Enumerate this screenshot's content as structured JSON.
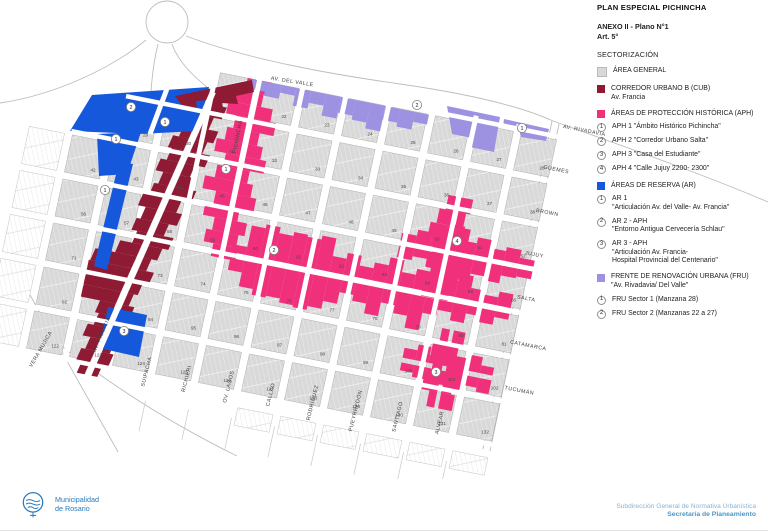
{
  "header": {
    "title": "PLAN ESPECIAL PICHINCHA",
    "anexo": "ANEXO II - Plano N°1",
    "art": "Art. 5°",
    "section": "SECTORIZACIÓN"
  },
  "colors": {
    "area_general": "#d9d9d9",
    "cub": "#8e1a33",
    "aph": "#f0307a",
    "ar": "#1558dc",
    "fru": "#9d92e2",
    "brand_blue": "#2779bd"
  },
  "legend": {
    "area_general": {
      "label": "ÁREA GENERAL"
    },
    "cub": {
      "label": "CORREDOR URBANO B (CUB)",
      "sub": "Av. Francia"
    },
    "aph": {
      "label": "ÁREAS DE PROTECCIÓN HISTÓRICA (APH)",
      "items": [
        {
          "n": "1",
          "text": "APH 1  \"Ámbito Histórico Pichincha\""
        },
        {
          "n": "2",
          "text": "APH 2  \"Corredor Urbano Salta\""
        },
        {
          "n": "3",
          "text": "APH 3  \"Casa del Estudiante\""
        },
        {
          "n": "4",
          "text": "APH 4  \"Calle Jujuy 2200- 2300\""
        }
      ]
    },
    "ar": {
      "label": "ÁREAS DE RESERVA (AR)",
      "items": [
        {
          "n": "1",
          "lines": [
            "AR 1",
            "\"Articulación Av. del Valle- Av. Francia\""
          ]
        },
        {
          "n": "2",
          "lines": [
            "AR 2 - APH",
            "\"Entorno Antigua Cervecería Schlau\""
          ]
        },
        {
          "n": "3",
          "lines": [
            "AR 3 - APH",
            "\"Articulación Av. Francia-",
            "Hospital Provincial del Centenario\""
          ]
        }
      ]
    },
    "fru": {
      "label": "FRENTE DE RENOVACIÓN URBANA (FRU)",
      "sub": "\"Av. Rivadavia/ Del Valle\"",
      "items": [
        {
          "n": "1",
          "text": "FRU Sector 1 (Manzana 28)"
        },
        {
          "n": "2",
          "text": "FRU Sector 2 (Manzanas 22 a 27)"
        }
      ]
    }
  },
  "footer": {
    "org_line1": "Municipalidad",
    "org_line2": "de Rosario",
    "right_line1": "Subdirección General de Normativa Urbanística",
    "right_line2": "Secretaría de Planeamiento"
  },
  "map": {
    "loop": {
      "cx": 167,
      "cy": 22,
      "r": 21
    },
    "decor": [
      "M 0 103 C 55 95 112 68 146 40",
      "M 172 44 C 178 62 194 77 213 92",
      "M 158 44 C 151 72 150 100 150 133",
      "M 186 36 C 250 60 330 74 400 84 C 470 94 522 107 553 121",
      "M 553 121 C 640 152 712 178 768 202",
      "M 552 121 L 483 449",
      "M 559 124 L 490 451",
      "M 30 295 L 118 452",
      "M 60 345 C 120 392 180 428 237 456"
    ],
    "block_rows": [
      {
        "row": 0,
        "start_col": 3,
        "numbers": [
          "",
          "22",
          "23",
          "24",
          "25",
          "26",
          "27",
          "28"
        ]
      },
      {
        "row": 1,
        "start_col": 1,
        "numbers": [
          "29",
          "30",
          "31",
          "32",
          "33",
          "34",
          "35",
          "36",
          "37",
          "38"
        ]
      },
      {
        "row": 2,
        "start_col": 0,
        "numbers": [
          "42",
          "43",
          "44",
          "45",
          "46",
          "47",
          "48",
          "49",
          "50",
          "51",
          "52"
        ]
      },
      {
        "row": 3,
        "start_col": 0,
        "numbers": [
          "56",
          "57",
          "58",
          "59",
          "60",
          "61",
          "62",
          "63",
          "64",
          "65",
          "66"
        ]
      },
      {
        "row": 4,
        "start_col": 0,
        "numbers": [
          "71",
          "72",
          "73",
          "74",
          "75",
          "76",
          "77",
          "78",
          "79",
          "80",
          "81"
        ]
      },
      {
        "row": 5,
        "start_col": 0,
        "numbers": [
          "92",
          "93",
          "94",
          "95",
          "96",
          "97",
          "98",
          "99",
          "100",
          "101",
          "102"
        ]
      },
      {
        "row": 6,
        "start_col": 0,
        "numbers": [
          "122",
          "123",
          "124",
          "125",
          "126",
          "127",
          "128",
          "129",
          "130",
          "131",
          "132"
        ]
      }
    ],
    "white_blocks": [
      {
        "row": 2,
        "col": -1
      },
      {
        "row": 3,
        "col": -1
      },
      {
        "row": 4,
        "col": -1
      },
      {
        "row": 5,
        "col": -1
      },
      {
        "row": 6,
        "col": -1
      },
      {
        "row": 7,
        "col": 5,
        "sv": 9
      },
      {
        "row": 7,
        "col": 6,
        "sv": 9
      },
      {
        "row": 7,
        "col": 7,
        "sv": 9
      },
      {
        "row": 7,
        "col": 8,
        "sv": 9
      },
      {
        "row": 7,
        "col": 9,
        "sv": 9
      },
      {
        "row": 7,
        "col": 10,
        "sv": 9
      }
    ],
    "corridors": [
      {
        "name": "cub-av-francia",
        "fill": "#8e1a33",
        "dir": "U",
        "street": 7,
        "line": [
          [
            213,
            92
          ],
          [
            88,
            375
          ]
        ],
        "left": [
          12,
          8,
          14,
          10,
          16,
          12,
          18,
          10,
          14,
          20,
          12,
          16,
          10,
          22,
          42,
          44,
          40,
          38,
          16,
          12,
          18,
          10,
          14,
          8
        ],
        "right": [
          10,
          16,
          8,
          18,
          12,
          20,
          10,
          16,
          22,
          12,
          18,
          10,
          20,
          14,
          8,
          16,
          10,
          6,
          12,
          0,
          0,
          8,
          12,
          6
        ]
      },
      {
        "name": "aph1-pichincha",
        "fill": "#f0307a",
        "dir": "U",
        "street": 5,
        "line": [
          [
            258,
            80
          ],
          [
            221,
            258
          ]
        ],
        "left": [
          8,
          16,
          22,
          12,
          18,
          26,
          14,
          20,
          30,
          16,
          24,
          12,
          18,
          8
        ],
        "right": [
          12,
          6,
          18,
          24,
          10,
          16,
          22,
          8,
          14,
          20,
          6,
          16,
          10,
          12
        ]
      },
      {
        "name": "aph2-corredor-salta",
        "fill": "#f0307a",
        "dir": "V",
        "street": 6,
        "line": [
          [
            231,
            255
          ],
          [
            510,
            311
          ]
        ],
        "left": [
          8,
          30,
          34,
          28,
          32,
          30,
          34,
          16,
          22,
          12,
          18,
          26,
          14,
          20,
          10,
          16,
          24,
          12,
          8,
          14
        ],
        "right": [
          12,
          26,
          32,
          30,
          34,
          36,
          32,
          24,
          12,
          18,
          28,
          14,
          22,
          34,
          16,
          10,
          18,
          8,
          14,
          6
        ]
      },
      {
        "name": "aph4-calle-jujuy-h",
        "fill": "#f0307a",
        "dir": "V",
        "street": 5,
        "line": [
          [
            400,
            243
          ],
          [
            533,
            269
          ]
        ],
        "left": [
          8,
          14,
          20,
          26,
          12,
          18,
          10,
          14,
          6
        ],
        "right": [
          12,
          8,
          16,
          30,
          22,
          14,
          18,
          10,
          8
        ]
      },
      {
        "name": "aph4-calle-jujuy-v",
        "fill": "#f0307a",
        "dir": "U",
        "street": 5,
        "line": [
          [
            459,
            197
          ],
          [
            437,
            299
          ]
        ],
        "left": [
          8,
          14,
          20,
          12,
          16,
          10,
          14
        ],
        "right": [
          12,
          8,
          16,
          22,
          10,
          14,
          8
        ]
      },
      {
        "name": "aph3-casa-estudiante-h",
        "fill": "#f0307a",
        "dir": "V",
        "street": 5,
        "line": [
          [
            402,
            360
          ],
          [
            492,
            378
          ]
        ],
        "left": [
          10,
          16,
          8,
          20,
          12,
          16,
          8
        ],
        "right": [
          8,
          12,
          22,
          14,
          18,
          10,
          14
        ]
      },
      {
        "name": "aph3-casa-estudiante-v",
        "fill": "#f0307a",
        "dir": "U",
        "street": 4,
        "line": [
          [
            452,
            330
          ],
          [
            436,
            408
          ]
        ],
        "left": [
          8,
          14,
          10,
          16,
          8
        ],
        "right": [
          12,
          8,
          18,
          10,
          14
        ]
      },
      {
        "name": "fru-del-valle-strip",
        "fill": "#9d92e2",
        "dir": "V",
        "street": 0,
        "line": [
          [
            252,
            79
          ],
          [
            430,
            115
          ]
        ],
        "left": [
          0,
          0,
          0,
          0,
          0,
          0,
          0,
          0,
          0,
          0,
          0,
          0
        ],
        "right": [
          10,
          14,
          8,
          18,
          12,
          22,
          16,
          20,
          26,
          14,
          18,
          10
        ]
      }
    ],
    "polys": [
      {
        "name": "ar-zone-north",
        "fill": "#1558dc",
        "points": "70,131 92,95 209,87 198,131 139,134"
      },
      {
        "name": "ar-zone-wedge",
        "fill": "#1558dc",
        "points": "97,134 141,132 127,174 99,176"
      },
      {
        "name": "ar-zone-band",
        "fill": "#1558dc",
        "points": "119,162 133,164 107,270 94,266"
      },
      {
        "name": "ar-zone-block-124",
        "fill": "#1558dc",
        "points": "108,307 147,315 139,357 99,348"
      },
      {
        "name": "cub-north-cluster",
        "fill": "#8e1a33",
        "points": "175,96 252,80 254,92 236,96 238,104 222,103 224,112 208,112 209,100 196,101 197,110 184,108"
      },
      {
        "name": "fru-block-27",
        "fill": "#9d92e2",
        "points": "447,106 500,117 494,152 470,147 472,138 452,134"
      },
      {
        "name": "fru-block-28",
        "fill": "#9d92e2",
        "points": "504,119 549,129 546,141 521,137 519,130 503,127"
      }
    ],
    "white_streets": [
      {
        "line": [
          [
            213,
            92
          ],
          [
            85,
            382
          ]
        ],
        "w": 6
      },
      {
        "line": [
          [
            168,
            86
          ],
          [
            150,
            134
          ]
        ],
        "w": 5
      }
    ],
    "v_streets": [
      {
        "b": 0.5,
        "r0": 3.1,
        "r1": 7.1
      },
      {
        "b": 2.5,
        "r0": -0.5,
        "r1": 7.1
      },
      {
        "b": 3.5,
        "r0": -0.5,
        "r1": 7.1
      },
      {
        "b": 4.5,
        "r0": -0.6,
        "r1": 7.1
      },
      {
        "b": 5.5,
        "r0": -0.6,
        "r1": 7.1
      },
      {
        "b": 6.5,
        "r0": -0.6,
        "r1": 7.1
      },
      {
        "b": 7.5,
        "r0": -0.6,
        "r1": 7.1
      },
      {
        "b": 8.5,
        "r0": -0.6,
        "r1": 7.1
      },
      {
        "b": 9.5,
        "r0": -0.6,
        "r1": 7.1
      }
    ],
    "h_streets": [
      {
        "rb": -0.5,
        "c0": 3.3,
        "c1": 10.5
      },
      {
        "rb": 0.5,
        "c0": 0.6,
        "c1": 10.5
      },
      {
        "rb": 1.5,
        "c0": -0.45,
        "c1": 10.5
      },
      {
        "rb": 2.5,
        "c0": -0.45,
        "c1": 10.5
      },
      {
        "rb": 3.5,
        "c0": -0.45,
        "c1": 10.5
      },
      {
        "rb": 4.5,
        "c0": -0.45,
        "c1": 10.5
      },
      {
        "rb": 5.5,
        "c0": -0.45,
        "c1": 10.5
      },
      {
        "rb": 6.5,
        "c0": 0.2,
        "c1": 10.5
      }
    ],
    "stub_cols": [
      2.5,
      3.5,
      4.5,
      5.5,
      6.5,
      7.5,
      8.5,
      9.5
    ],
    "streets": [
      {
        "label": "AV. DEL VALLE",
        "x": 292,
        "y": 83,
        "rot": 9
      },
      {
        "label": "AV. RIVADAVIA",
        "x": 584,
        "y": 132,
        "rot": 11
      },
      {
        "label": "GÜEMES",
        "x": 556,
        "y": 171,
        "rot": 11
      },
      {
        "label": "BROWN",
        "x": 547,
        "y": 214,
        "rot": 11
      },
      {
        "label": "JUJUY",
        "x": 534,
        "y": 256,
        "rot": 11
      },
      {
        "label": "SALTA",
        "x": 526,
        "y": 300,
        "rot": 11
      },
      {
        "label": "CATAMARCA",
        "x": 528,
        "y": 347,
        "rot": 11
      },
      {
        "label": "TUCUMÁN",
        "x": 519,
        "y": 392,
        "rot": 11
      },
      {
        "label": "PICHINCHA",
        "x": 239,
        "y": 137,
        "rot": -79
      },
      {
        "label": "VERA MUJICA",
        "x": 42,
        "y": 350,
        "rot": -60
      },
      {
        "label": "AV. FRANCIA",
        "x": 103,
        "y": 335,
        "rot": -67
      },
      {
        "label": "SUIPACHA",
        "x": 148,
        "y": 372,
        "rot": -76
      },
      {
        "label": "RICHIERI",
        "x": 188,
        "y": 379,
        "rot": -76
      },
      {
        "label": "OV. LAGOS",
        "x": 230,
        "y": 387,
        "rot": -76
      },
      {
        "label": "CALLAO",
        "x": 272,
        "y": 395,
        "rot": -76
      },
      {
        "label": "RODRÍGUEZ",
        "x": 314,
        "y": 403,
        "rot": -76
      },
      {
        "label": "PUEYRREDÓN",
        "x": 357,
        "y": 411,
        "rot": -76
      },
      {
        "label": "SANTIAGO",
        "x": 399,
        "y": 417,
        "rot": -76
      },
      {
        "label": "ALVEAR",
        "x": 441,
        "y": 423,
        "rot": -76
      }
    ],
    "markers": [
      {
        "n": "2",
        "x": 131,
        "y": 107
      },
      {
        "n": "1",
        "x": 165,
        "y": 122
      },
      {
        "n": "1",
        "x": 116,
        "y": 139
      },
      {
        "n": "1",
        "x": 105,
        "y": 190
      },
      {
        "n": "3",
        "x": 124,
        "y": 331
      },
      {
        "n": "1",
        "x": 226,
        "y": 169
      },
      {
        "n": "2",
        "x": 274,
        "y": 250
      },
      {
        "n": "4",
        "x": 457,
        "y": 241
      },
      {
        "n": "3",
        "x": 436,
        "y": 372
      },
      {
        "n": "2",
        "x": 417,
        "y": 105
      },
      {
        "n": "1",
        "x": 522,
        "y": 128
      }
    ]
  }
}
